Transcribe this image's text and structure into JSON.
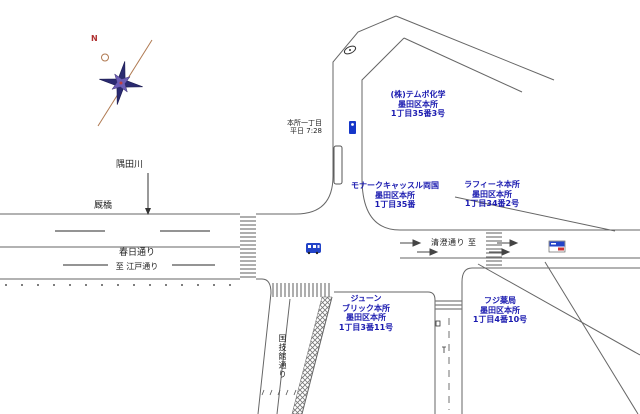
{
  "compass": {
    "north": "N"
  },
  "landmarks": {
    "river": "隅田川",
    "bridge": "厩橋"
  },
  "roads": {
    "kasuga": "春日通り",
    "kasuga_dest": "至 江戸通り",
    "kiyosumi": "清澄通り 至",
    "kokugikan": "国技館通り"
  },
  "sign": {
    "line1": "本所一丁目",
    "line2": "平日 7:28"
  },
  "buildings": [
    {
      "lines": [
        "(株)テムポ化学",
        "墨田区本所",
        "1丁目35番3号"
      ]
    },
    {
      "lines": [
        "モナークキャッスル両国",
        "墨田区本所",
        "1丁目35番"
      ]
    },
    {
      "lines": [
        "ラフィーネ本所",
        "墨田区本所",
        "1丁目34番2号"
      ]
    },
    {
      "lines": [
        "ジューン",
        "ブリック本所",
        "墨田区本所",
        "1丁目3番11号"
      ]
    },
    {
      "lines": [
        "フジ薬局",
        "墨田区本所",
        "1丁目4番10号"
      ]
    }
  ],
  "colors": {
    "label_blue": "#1b1bb0",
    "road_line": "#666666",
    "compass_star": "#2a2a70",
    "compass_line": "#b07a52"
  }
}
